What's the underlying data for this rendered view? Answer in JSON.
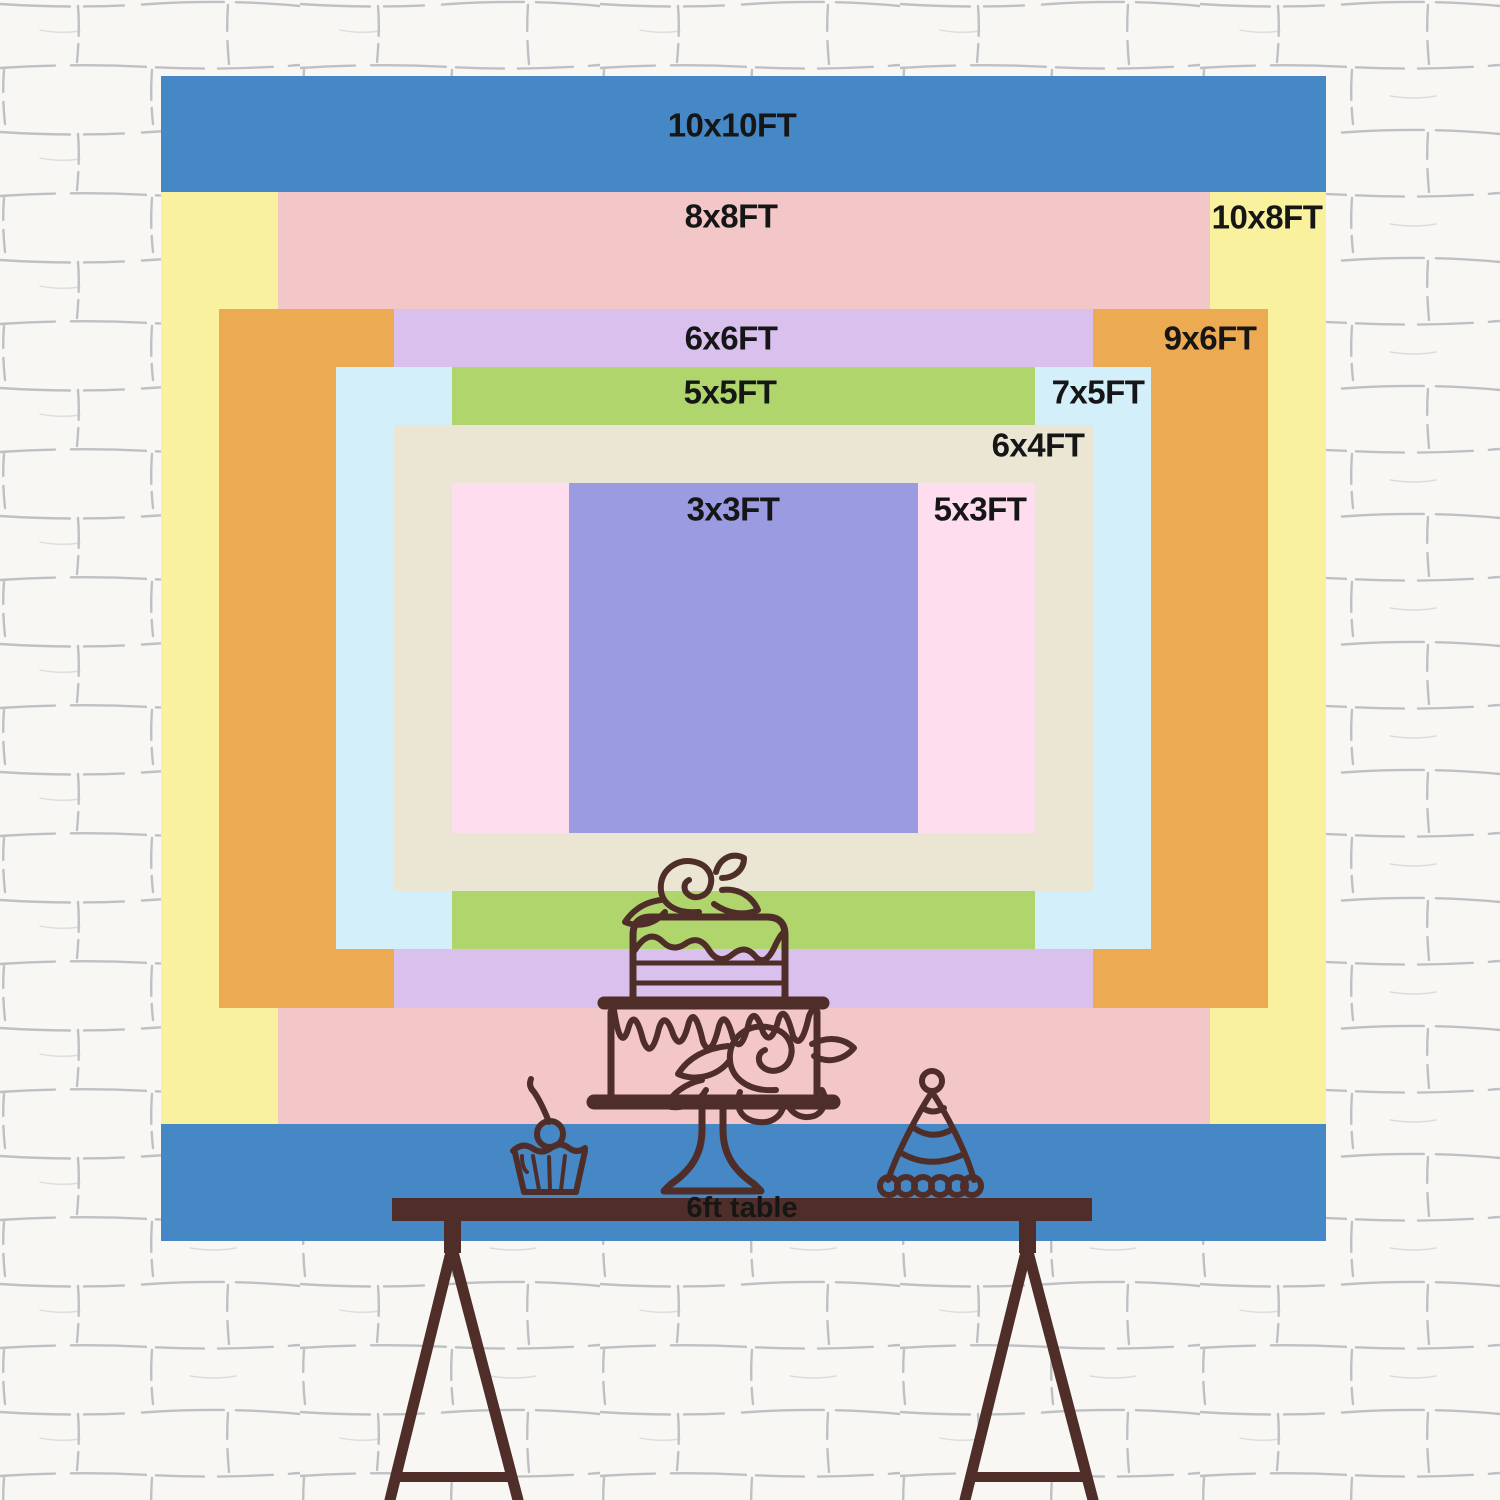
{
  "chart_data": {
    "type": "nested_rectangles",
    "unit": "FT",
    "sizes": [
      {
        "label": "10x10FT",
        "width_ft": 10,
        "height_ft": 10,
        "color": "#4687c5"
      },
      {
        "label": "10x8FT",
        "width_ft": 10,
        "height_ft": 8,
        "color": "#faf19e"
      },
      {
        "label": "8x8FT",
        "width_ft": 8,
        "height_ft": 8,
        "color": "#f3c7c8"
      },
      {
        "label": "9x6FT",
        "width_ft": 9,
        "height_ft": 6,
        "color": "#ecaa53"
      },
      {
        "label": "6x6FT",
        "width_ft": 6,
        "height_ft": 6,
        "color": "#d9c0ed"
      },
      {
        "label": "7x5FT",
        "width_ft": 7,
        "height_ft": 5,
        "color": "#d3eff9"
      },
      {
        "label": "5x5FT",
        "width_ft": 5,
        "height_ft": 5,
        "color": "#afd56c"
      },
      {
        "label": "6x4FT",
        "width_ft": 6,
        "height_ft": 4,
        "color": "#ebe6d4"
      },
      {
        "label": "5x3FT",
        "width_ft": 5,
        "height_ft": 3,
        "color": "#fdddee"
      },
      {
        "label": "3x3FT",
        "width_ft": 3,
        "height_ft": 3,
        "color": "#9a9be0"
      }
    ],
    "table_label": "6ft table",
    "text_color": "#161616",
    "illustration_color": "#4f2e29"
  }
}
